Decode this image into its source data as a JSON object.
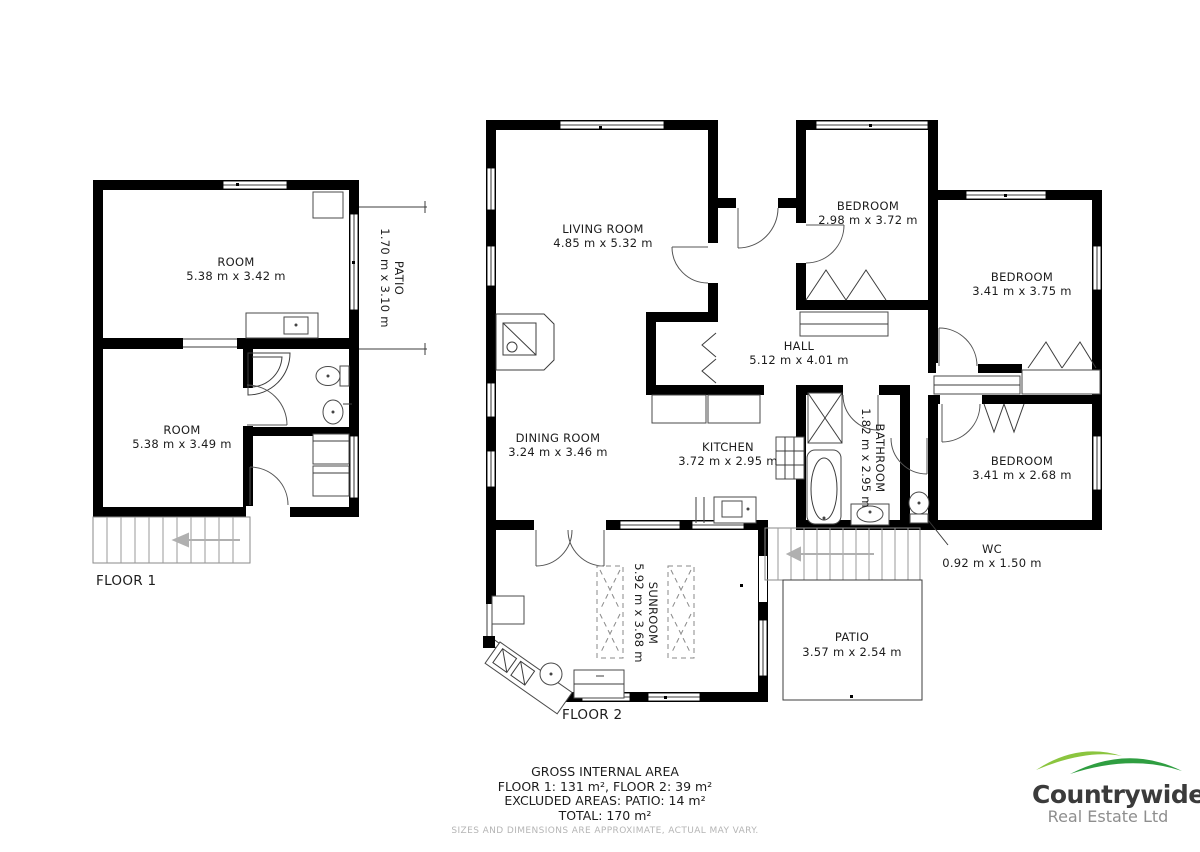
{
  "floor1": {
    "label": "FLOOR 1",
    "room_top": {
      "name": "ROOM",
      "dims": "5.38 m x 3.42 m"
    },
    "room_bottom": {
      "name": "ROOM",
      "dims": "5.38 m x 3.49 m"
    },
    "patio": {
      "name": "PATIO",
      "dims": "1.70 m x 3.10 m"
    }
  },
  "floor2": {
    "label": "FLOOR 2",
    "living": {
      "name": "LIVING ROOM",
      "dims": "4.85 m x 5.32 m"
    },
    "bedroom_left": {
      "name": "BEDROOM",
      "dims": "2.98 m x 3.72 m"
    },
    "bedroom_top_right": {
      "name": "BEDROOM",
      "dims": "3.41 m x 3.75 m"
    },
    "hall": {
      "name": "HALL",
      "dims": "5.12 m x 4.01 m"
    },
    "dining": {
      "name": "DINING ROOM",
      "dims": "3.24 m x 3.46 m"
    },
    "kitchen": {
      "name": "KITCHEN",
      "dims": "3.72 m x 2.95 m"
    },
    "bathroom": {
      "name": "BATHROOM",
      "dims": "1.82 m x 2.95 m"
    },
    "bedroom_bottom_right": {
      "name": "BEDROOM",
      "dims": "3.41 m x 2.68 m"
    },
    "wc": {
      "name": "WC",
      "dims": "0.92 m x 1.50 m"
    },
    "sunroom": {
      "name": "SUNROOM",
      "dims": "5.92 m x 3.68 m"
    },
    "patio": {
      "name": "PATIO",
      "dims": "3.57 m x 2.54 m"
    }
  },
  "footer": {
    "title": "GROSS INTERNAL AREA",
    "line_floors": "FLOOR 1: 131 m², FLOOR 2: 39 m²",
    "line_excluded": "EXCLUDED AREAS: PATIO: 14 m²",
    "line_total": "TOTAL: 170 m²",
    "disclaimer": "SIZES AND DIMENSIONS ARE APPROXIMATE, ACTUAL MAY VARY."
  },
  "logo": {
    "name": "Countrywide",
    "subtitle": "Real Estate Ltd",
    "hill_light": "#8bc53f",
    "hill_dark": "#2f9e41"
  },
  "colors": {
    "wall": "#000000",
    "line": "#3c3c3c",
    "disclaimer_text": "#b5b5b5"
  }
}
